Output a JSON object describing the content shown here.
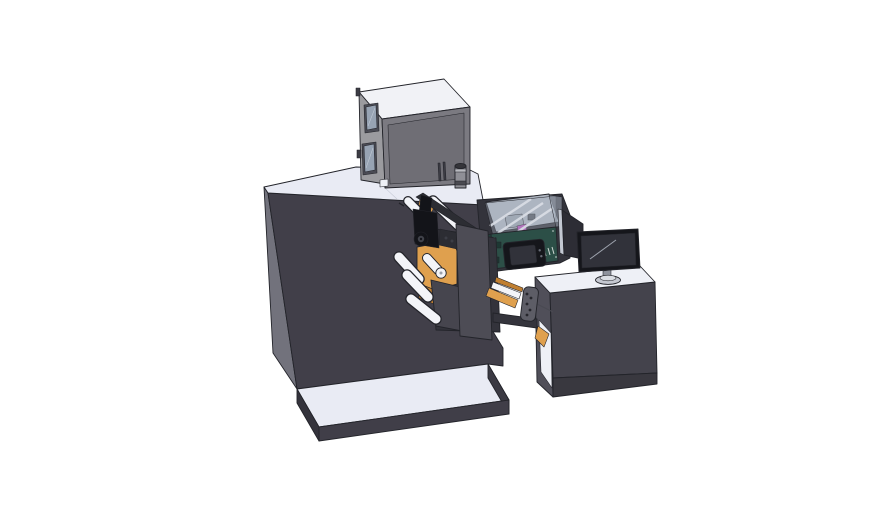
{
  "meta": {
    "title": "3D CAD shaded render of a narrow-web label printing machine with operator desk",
    "render_style": "solid shaded model with black edge lines on white background"
  },
  "objects": [
    {
      "id": "print-engine-box",
      "desc": "light gray printer engine unit sitting on cabinet top"
    },
    {
      "id": "exhaust-cylinder",
      "desc": "small gray cylinder beside the printer unit"
    },
    {
      "id": "main-cabinet",
      "desc": "large dark enclosure with white top deck"
    },
    {
      "id": "unwind-mechanism",
      "desc": "web unwind station with orange side plates, white guide rollers and black head assembly"
    },
    {
      "id": "inspection-chamber",
      "desc": "open-top tinted chamber with white rails and magenta component"
    },
    {
      "id": "control-module",
      "desc": "dark teal control box with small touchscreen"
    },
    {
      "id": "side-screen-panel",
      "desc": "flat display panel standing edge-on"
    },
    {
      "id": "operator-desk",
      "desc": "dark desk with white top and open left side"
    },
    {
      "id": "monitor",
      "desc": "desktop monitor on round pedestal stand"
    },
    {
      "id": "base-platform",
      "desc": "floor platform with white top surface"
    }
  ],
  "colors": {
    "background": "#ffffff",
    "outline": "#23242a",
    "surface": "#e9ebf4",
    "surfaceBright": "#eef0f6",
    "cabinetFront": "#413f49",
    "cabinetSide": "#72727c",
    "boxTop": "#f1f2f6",
    "boxLeft": "#9b9b9f",
    "boxRight": "#7b7a81",
    "boxInset": "#6f6e75",
    "boxSlot": "#3c3c44",
    "windowFrame": "#4a4b54",
    "windowGlass": "#97a3b3",
    "glassReflect": "#c2cbd6",
    "cylBody": "#8f8f96",
    "cylCap": "#35353a",
    "cylBand": "#4a4a51",
    "cylRing": "#b9bac0",
    "backdrop": "#33333b",
    "chamberFloor": "#c3cbd7",
    "chamberWall": "#aeb8c6",
    "rib": "#f2f4f8",
    "internalGray": "#99a1ad",
    "internalDark": "#555a63",
    "magenta": "#b44fb8",
    "teal": "#2c4f47",
    "tealDark": "#223f39",
    "tealDetail": "#1d3833",
    "ventLight": "#cfd8d4",
    "screwLight": "#8fa39d",
    "bezel": "#15161b",
    "screenFill": "#31323a",
    "screenGlare": "#b9bfca",
    "btnDot": "#6a6e78",
    "panelDark": "#2d2d35",
    "panelEdge": "#c3c8d2",
    "deskFront": "#44434c",
    "deskLower": "#39383f",
    "deskSide": "#504f59",
    "monNeck": "#8e929c",
    "monBase": "#c5c8d1",
    "monBaseTop": "#dadde3",
    "orange": "#dfa04e",
    "orangeDark": "#c07f31",
    "roller": "#f3f4f8",
    "rollerDot": "#9aa0ab",
    "black": "#131419",
    "black2": "#2c2d33",
    "gearRing": "#41434b",
    "boltGray": "#3c3e46",
    "platePanel": "#4d4c55",
    "lowerPanel": "#46454e",
    "bar": "#34343c",
    "bracket": "#5d5d66",
    "bracketHole": "#26262c",
    "wire": "#4a4a52",
    "seamLight": "#c5c9d4",
    "platformFront": "#403e48",
    "platformLeft": "#34333c",
    "platformRight": "#3b3a43"
  }
}
